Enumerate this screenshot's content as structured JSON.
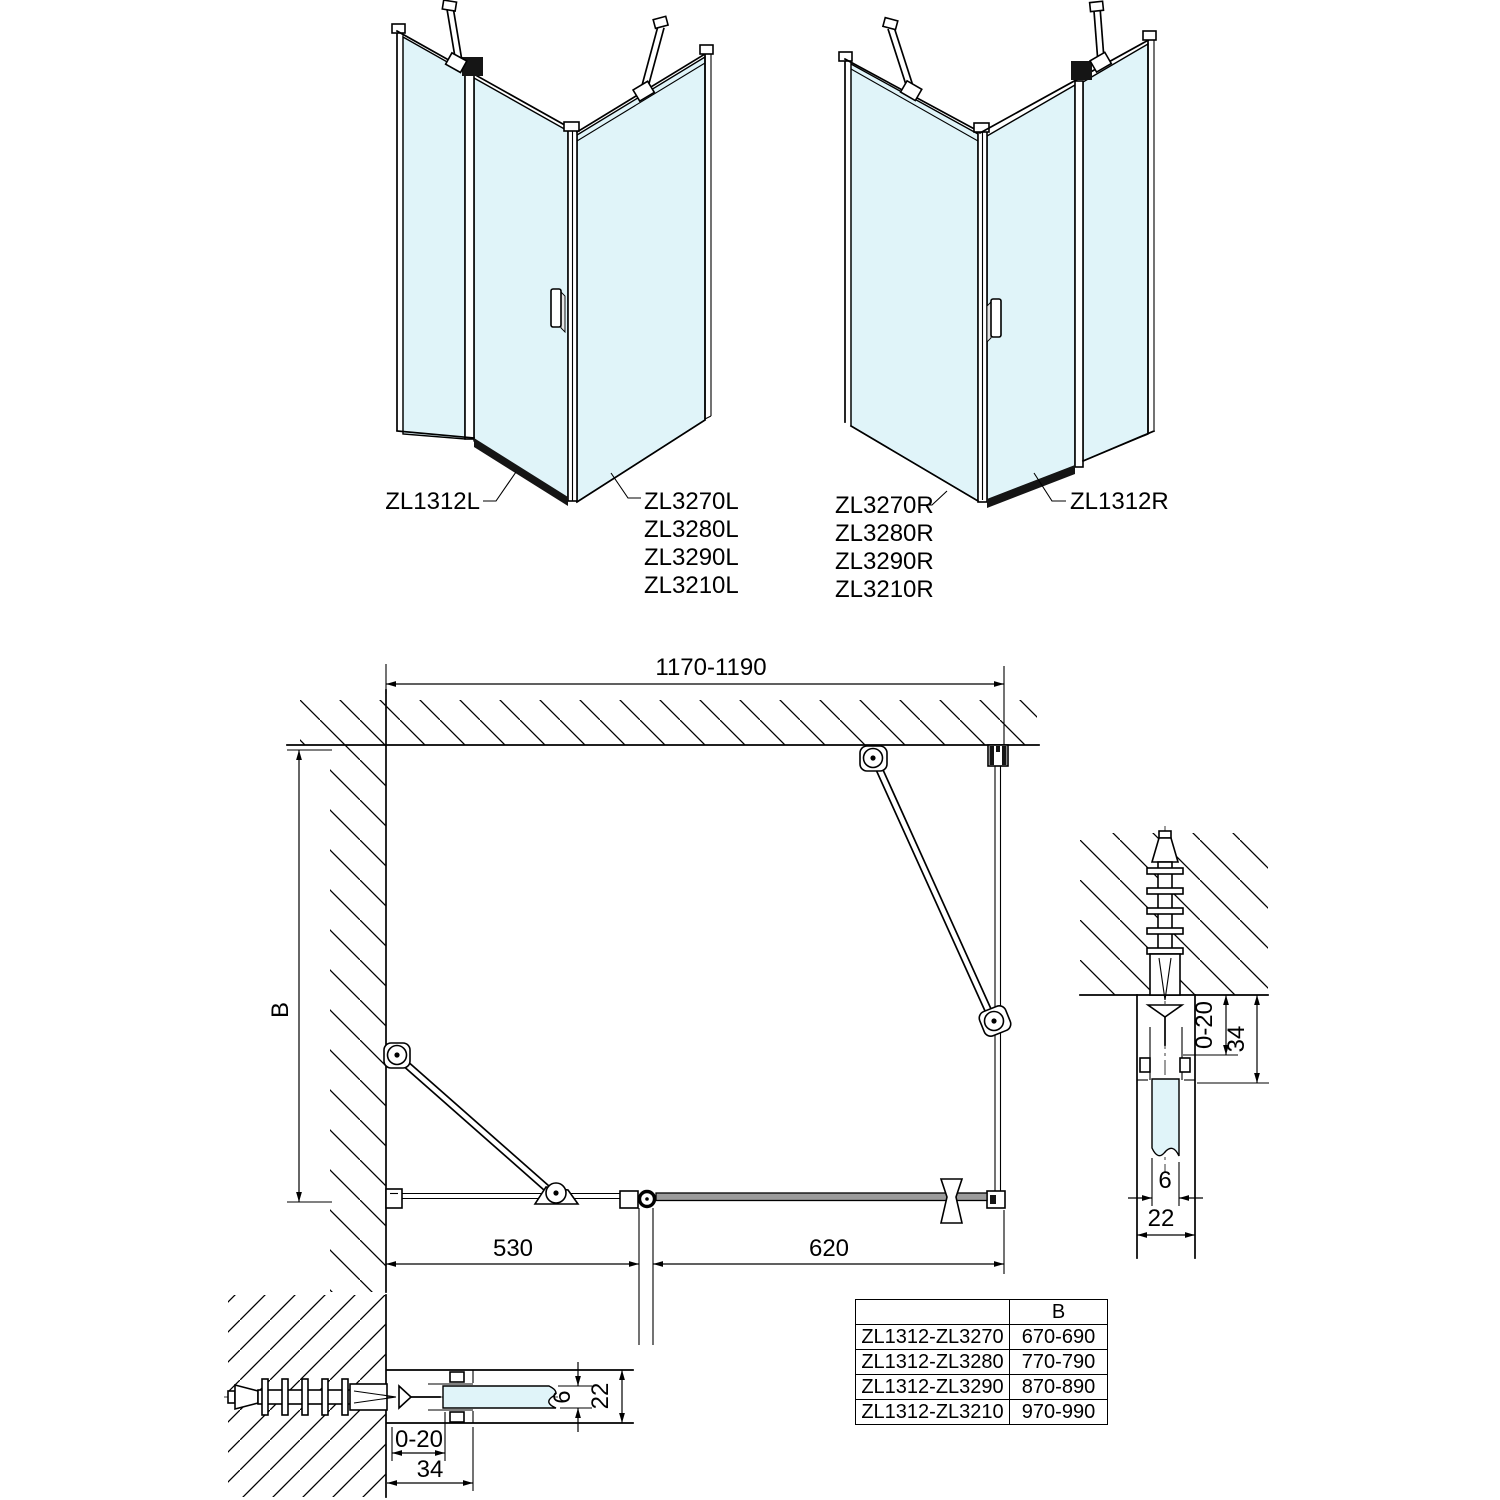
{
  "colors": {
    "glass": "#e0f4f9",
    "line": "#000000",
    "background": "#ffffff"
  },
  "iso_left": {
    "door_label": "ZL1312L",
    "panel_labels": [
      "ZL3270L",
      "ZL3280L",
      "ZL3290L",
      "ZL3210L"
    ]
  },
  "iso_right": {
    "door_label": "ZL1312R",
    "panel_labels": [
      "ZL3270R",
      "ZL3280R",
      "ZL3290R",
      "ZL3210R"
    ]
  },
  "plan": {
    "width_dim": "1170-1190",
    "depth_dim": "B",
    "door_dim": "530",
    "fixed_dim": "620"
  },
  "detail_right": {
    "adjust_dim": "0-20",
    "profile_dim": "34",
    "glass_dim": "6",
    "thickness_dim": "22"
  },
  "detail_bottom": {
    "adjust_dim": "0-20",
    "profile_dim": "34",
    "glass_dim": "6",
    "thickness_dim": "22"
  },
  "table": {
    "col_b_header": "B",
    "rows": [
      {
        "model": "ZL1312-ZL3270",
        "b": "670-690"
      },
      {
        "model": "ZL1312-ZL3280",
        "b": "770-790"
      },
      {
        "model": "ZL1312-ZL3290",
        "b": "870-890"
      },
      {
        "model": "ZL1312-ZL3210",
        "b": "970-990"
      }
    ]
  }
}
